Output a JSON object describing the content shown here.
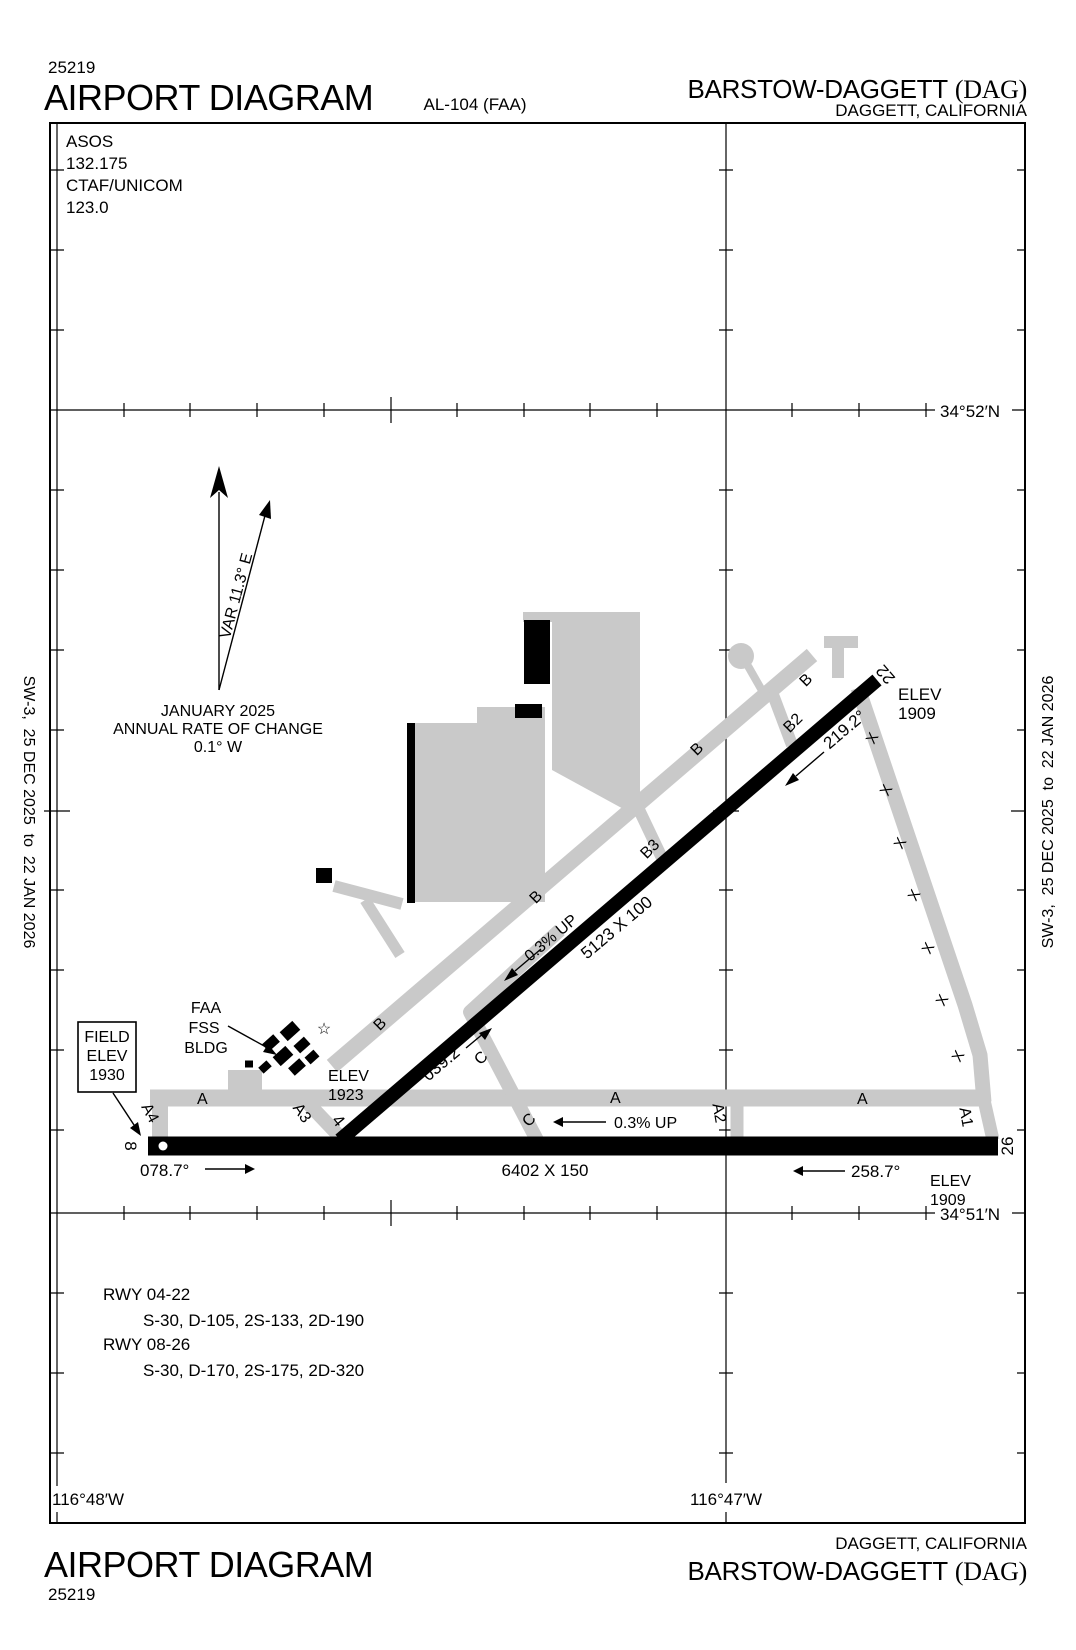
{
  "header": {
    "chart_number": "25219",
    "title": "AIRPORT DIAGRAM",
    "plate_id": "AL-104 (FAA)",
    "airport_name": "BARSTOW-DAGGETT",
    "airport_code": "(DAG)",
    "city_state": "DAGGETT, CALIFORNIA"
  },
  "footer": {
    "chart_number": "25219",
    "title": "AIRPORT DIAGRAM",
    "airport_name": "BARSTOW-DAGGETT",
    "airport_code": "(DAG)",
    "city_state": "DAGGETT, CALIFORNIA"
  },
  "margin_revision": "SW-3,  25 DEC 2025  to  22 JAN 2026",
  "comm": {
    "asos_label": "ASOS",
    "asos_freq": "132.175",
    "ctaf_label": "CTAF/UNICOM",
    "ctaf_freq": "123.0"
  },
  "compass": {
    "var_label": "VAR 11.3° E",
    "date": "JANUARY 2025",
    "rate_label": "ANNUAL RATE OF CHANGE",
    "rate_value": "0.1° W"
  },
  "coords": {
    "lat_top": "34°52′N",
    "lat_bottom": "34°51′N",
    "lon_left": "116°48′W",
    "lon_right": "116°47′W"
  },
  "field_elev": {
    "line1": "FIELD",
    "line2": "ELEV",
    "line3": "1930"
  },
  "fss": {
    "line1": "FAA",
    "line2": "FSS",
    "line3": "BLDG"
  },
  "beacon_icon": "☆",
  "runway_04_22": {
    "num_sw": "4",
    "num_ne": "22",
    "dimensions": "5123 X 100",
    "heading_ne": "039.2°",
    "heading_sw": "219.2°",
    "slope": "0.3% UP",
    "elev_ne_label": "ELEV",
    "elev_ne_value": "1909",
    "elev_sw_label": "ELEV",
    "elev_sw_value": "1923"
  },
  "runway_08_26": {
    "num_w": "8",
    "num_e": "26",
    "dimensions": "6402 X 150",
    "heading_e": "078.7°",
    "heading_w": "258.7°",
    "slope": "0.3% UP",
    "elev_e_label": "ELEV",
    "elev_e_value": "1909"
  },
  "taxiways": {
    "a": "A",
    "a1": "A1",
    "a2": "A2",
    "a3": "A3",
    "a4": "A4",
    "b": "B",
    "b2": "B2",
    "b3": "B3",
    "c": "C",
    "closed_marker": "X"
  },
  "data_block": {
    "rwy1_label": "RWY 04-22",
    "rwy1_data": "S-30, D-105, 2S-133, 2D-190",
    "rwy2_label": "RWY 08-26",
    "rwy2_data": "S-30, D-170, 2S-175, 2D-320"
  }
}
